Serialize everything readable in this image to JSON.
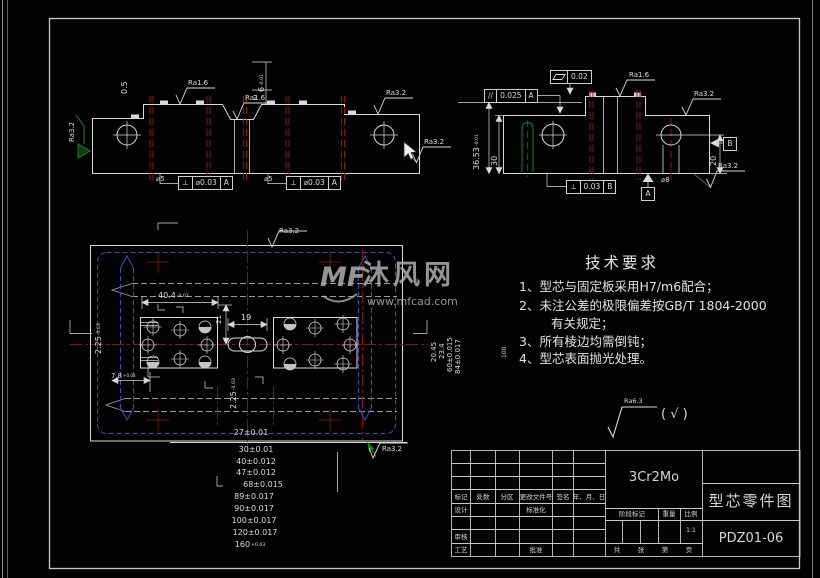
{
  "drawing": {
    "material": "3Cr2Mo",
    "part_title": "型芯零件图",
    "drawing_no": "PDZ01-06",
    "scale": "1:1"
  },
  "tech_req": {
    "title": "技术要求",
    "items": [
      "1、型芯与固定板采用H7/m6配合；",
      "2、未注公差的极限偏差按GB/T 1804-2000",
      "有关规定；",
      "3、所有棱边均需倒钝；",
      "4、型芯表面抛光处理。"
    ]
  },
  "finish_note": {
    "ra": "Ra6.3",
    "others": "( √ )"
  },
  "watermark": {
    "logo": "MF",
    "name": "沐风网",
    "url": "www.mfcad.com"
  },
  "gdt": {
    "perp1": {
      "sym": "⊥",
      "val": "⌀0.03",
      "ref": "A"
    },
    "perp2": {
      "sym": "⊥",
      "val": "⌀0.03",
      "ref": "A"
    },
    "flat": {
      "val": "0.02"
    },
    "para": {
      "sym": "//",
      "val": "0.025",
      "ref": "A"
    },
    "perp3": {
      "sym": "⊥",
      "val": "0.03",
      "ref": "B"
    },
    "datum_a": "A",
    "datum_b": "B"
  },
  "title_block": {
    "header_row": [
      "标记",
      "处数",
      "分区",
      "更改文件号",
      "签名",
      "年、月、日"
    ],
    "design": "设计",
    "standardize": "标准化",
    "review": "审核",
    "craft": "工艺",
    "approve": "批准",
    "stage_mark": "阶段标记",
    "weight": "重量",
    "scale_label": "比例",
    "scale_value": "1:1",
    "sheet_total": "共",
    "sheet_zhang": "张",
    "sheet_no": "第",
    "sheet_page": "页",
    "material": "3Cr2Mo",
    "part_title": "型芯零件图",
    "drawing_no": "PDZ01-06"
  },
  "labels": [
    {
      "n": "dim-0-5",
      "t": "0.5",
      "x": 121,
      "y": 94,
      "s": 8,
      "r": -90
    },
    {
      "n": "ra-1-6-label",
      "t": "Ra1.6",
      "x": 188,
      "y": 80,
      "s": 7
    },
    {
      "n": "ra-1-6-label",
      "t": "Ra1.6",
      "x": 245,
      "y": 95,
      "s": 7
    },
    {
      "n": "ra-3-2-label",
      "t": "Ra3.2",
      "x": 386,
      "y": 90,
      "s": 7
    },
    {
      "n": "ra-3-2-label",
      "t": "Ra3.2",
      "x": 424,
      "y": 139,
      "s": 7
    },
    {
      "n": "ra-3-2-label",
      "t": "Ra3.2",
      "x": 69,
      "y": 142,
      "s": 7,
      "r": -90
    },
    {
      "n": "dim-6",
      "t": "6",
      "tol": "-0.01",
      "x": 258,
      "y": 92,
      "s": 8,
      "r": -90
    },
    {
      "n": "dim-2",
      "t": "2",
      "x": 253,
      "y": 95,
      "s": 7
    },
    {
      "n": "dim-dia5",
      "t": "⌀5",
      "x": 156,
      "y": 176,
      "s": 7
    },
    {
      "n": "dim-dia5",
      "t": "⌀5",
      "x": 264,
      "y": 176,
      "s": 7
    },
    {
      "n": "dim-36-53",
      "t": "36.53",
      "tol": "-0.01",
      "x": 473,
      "y": 170,
      "s": 8,
      "r": -90
    },
    {
      "n": "dim-30",
      "t": "30",
      "x": 491,
      "y": 166,
      "s": 8,
      "r": -90
    },
    {
      "n": "dim-20",
      "t": "20",
      "x": 710,
      "y": 166,
      "s": 8,
      "r": -90
    },
    {
      "n": "ra-1-6-label",
      "t": "Ra1.6",
      "x": 629,
      "y": 72,
      "s": 7
    },
    {
      "n": "ra-3-2-label",
      "t": "Ra3.2",
      "x": 694,
      "y": 91,
      "s": 7
    },
    {
      "n": "ra-3-2-label",
      "t": "Ra3.2",
      "x": 718,
      "y": 163,
      "s": 7
    },
    {
      "n": "dim-dia8",
      "t": "⌀8",
      "x": 661,
      "y": 177,
      "s": 7
    },
    {
      "n": "dim-40-4",
      "t": "40.4",
      "tol": "-0.02",
      "x": 158,
      "y": 292,
      "s": 8
    },
    {
      "n": "dim-19",
      "t": "19",
      "x": 241,
      "y": 314,
      "s": 8
    },
    {
      "n": "dim-21",
      "t": "21",
      "x": 216,
      "y": 324,
      "s": 7,
      "r": -90
    },
    {
      "n": "dim-2-25",
      "t": "2.25",
      "tol": "-0.03",
      "x": 95,
      "y": 354,
      "s": 8,
      "r": -90
    },
    {
      "n": "dim-7-8",
      "t": "7.8",
      "tol": "+0.03",
      "x": 111,
      "y": 373,
      "s": 7
    },
    {
      "n": "dim-2-25",
      "t": "2.25",
      "tol": "-0.03",
      "x": 230,
      "y": 409,
      "s": 8,
      "r": -90
    },
    {
      "n": "dim-27",
      "t": "27±0.01",
      "x": 251,
      "y": 429,
      "s": 8,
      "a": "c"
    },
    {
      "n": "ra-3-2-label",
      "t": "Ra3.2",
      "x": 279,
      "y": 228,
      "s": 7
    },
    {
      "n": "dim-20-45",
      "t": "20.45",
      "x": 431,
      "y": 362,
      "s": 7,
      "r": -90
    },
    {
      "n": "dim-23-4",
      "t": "23.4",
      "x": 439,
      "y": 359,
      "s": 7,
      "r": -90
    },
    {
      "n": "dim-60",
      "t": "60±0.015",
      "x": 447,
      "y": 372,
      "s": 7,
      "r": -90
    },
    {
      "n": "dim-84",
      "t": "84±0.017",
      "x": 455,
      "y": 374,
      "s": 7,
      "r": -90
    },
    {
      "n": "dim-100-side",
      "t": "100",
      "x": 502,
      "y": 358,
      "s": 6,
      "r": -90
    },
    {
      "n": "dim-30-stack",
      "t": "30±0.01",
      "x": 256,
      "y": 446,
      "s": 8,
      "a": "c"
    },
    {
      "n": "dim-40-stack",
      "t": "40±0.012",
      "x": 256,
      "y": 457.5,
      "s": 8,
      "a": "c"
    },
    {
      "n": "dim-47-stack",
      "t": "47±0.012",
      "x": 256,
      "y": 469,
      "s": 8,
      "a": "c"
    },
    {
      "n": "dim-68-stack",
      "t": "68±0.015",
      "x": 263,
      "y": 480.5,
      "s": 8,
      "a": "c"
    },
    {
      "n": "dim-89-stack",
      "t": "89±0.017",
      "x": 254,
      "y": 492.5,
      "s": 8,
      "a": "c"
    },
    {
      "n": "dim-90-stack",
      "t": "90±0.017",
      "x": 254,
      "y": 504.5,
      "s": 8,
      "a": "c"
    },
    {
      "n": "dim-100-stack",
      "t": "100±0.017",
      "x": 254,
      "y": 516.5,
      "s": 8,
      "a": "c"
    },
    {
      "n": "dim-120-stack",
      "t": "120±0.017",
      "x": 255,
      "y": 528.5,
      "s": 8,
      "a": "c"
    },
    {
      "n": "dim-160-stack",
      "t": "160",
      "tol": "+0.03",
      "x": 250,
      "y": 541,
      "s": 8,
      "a": "c"
    },
    {
      "n": "ra-3-2-label",
      "t": "Ra3.2",
      "x": 382,
      "y": 446,
      "s": 7
    }
  ]
}
